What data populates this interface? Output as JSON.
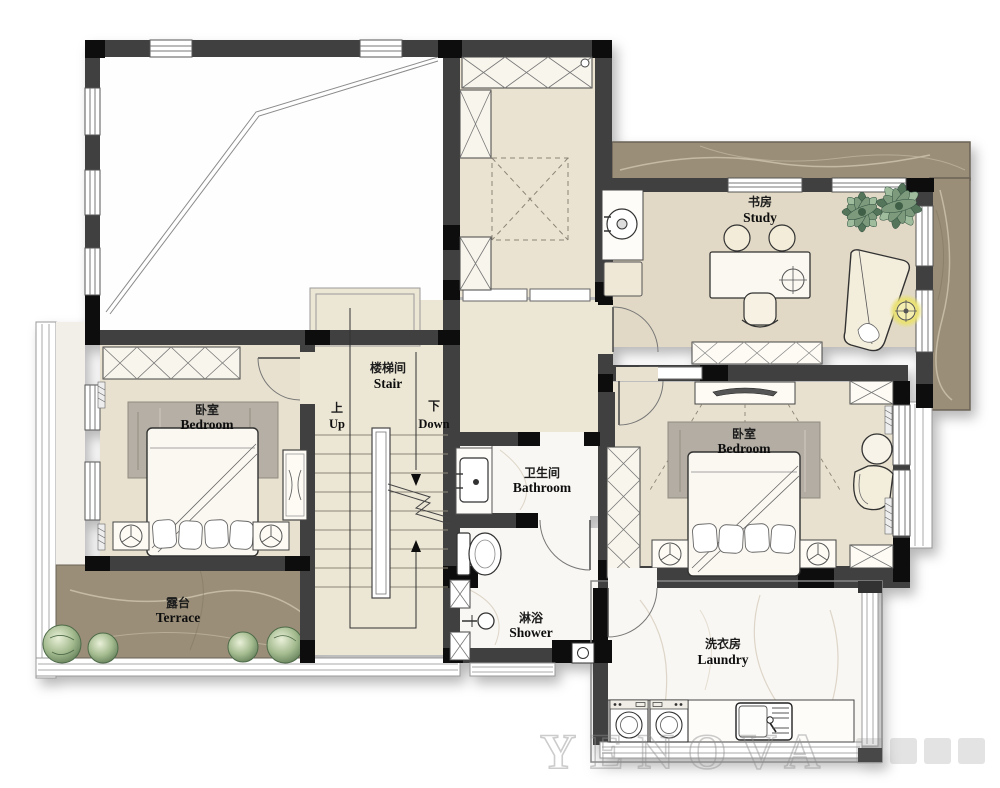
{
  "rooms": {
    "stair": {
      "zh": "楼梯间",
      "en": "Stair"
    },
    "up": {
      "zh": "上",
      "en": "Up"
    },
    "down": {
      "zh": "下",
      "en": "Down"
    },
    "bedroom_left": {
      "zh": "卧室",
      "en": "Bedroom"
    },
    "bedroom_right": {
      "zh": "卧室",
      "en": "Bedroom"
    },
    "study": {
      "zh": "书房",
      "en": "Study"
    },
    "bathroom": {
      "zh": "卫生间",
      "en": "Bathroom"
    },
    "shower": {
      "zh": "淋浴",
      "en": "Shower"
    },
    "laundry": {
      "zh": "洗衣房",
      "en": "Laundry"
    },
    "terrace": {
      "zh": "露台",
      "en": "Terrace"
    }
  },
  "watermark": "YENOVA",
  "colors": {
    "wall": "#414141",
    "wall_black": "#0d0d0d",
    "floor_beige": "#e8e1cf",
    "floor_stair": "#ece6d5",
    "floor_study": "#e1d9c5",
    "marble_white": "#f9f7f3",
    "marble_brown": "#9a8e78",
    "rug_gray": "#b5afa5",
    "plant_green": "#7d9674",
    "lamp_yellow": "#e9e175",
    "furniture_cream": "#faf7ef"
  }
}
